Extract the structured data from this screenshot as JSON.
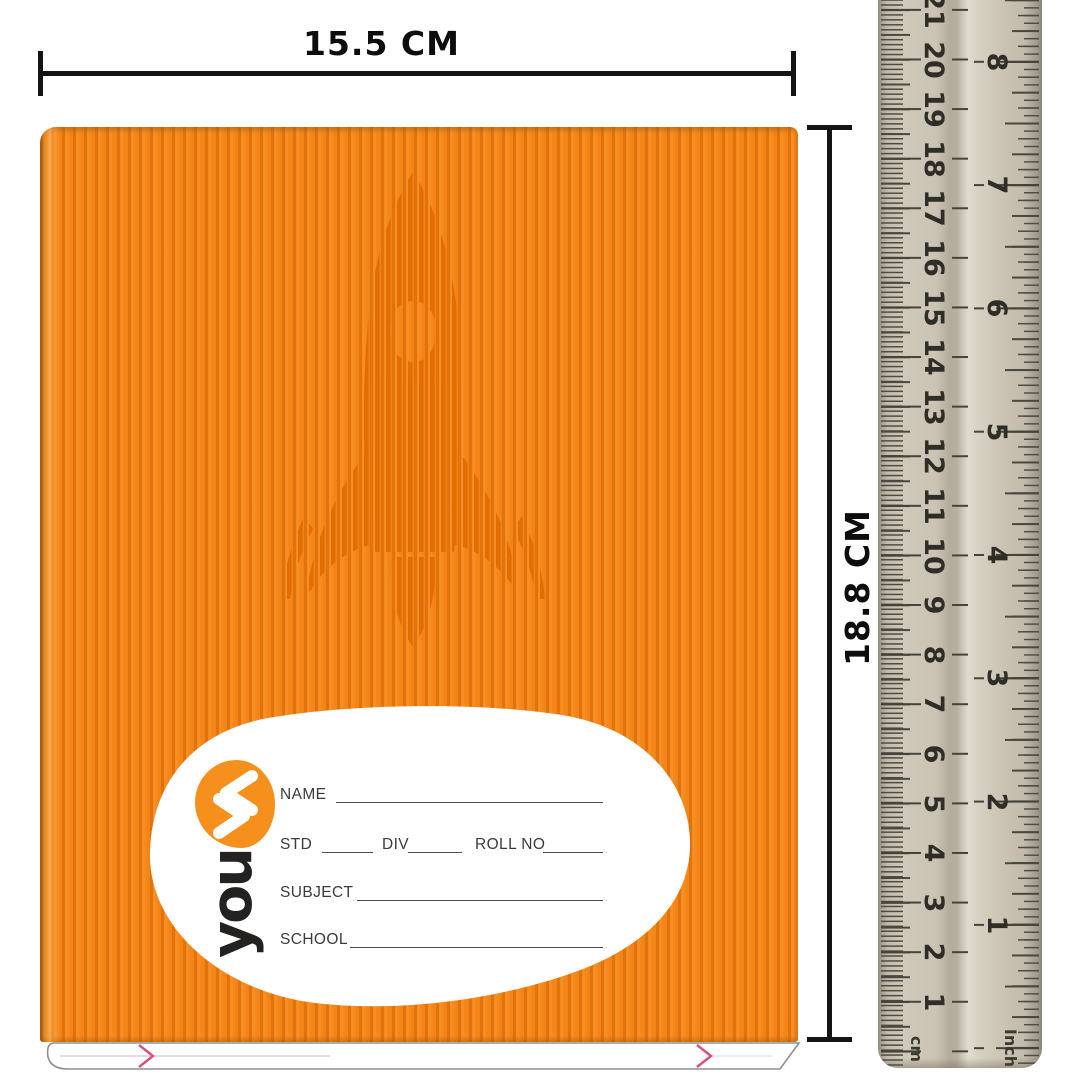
{
  "dimensions": {
    "width_label": "15.5 CM",
    "height_label": "18.8 CM"
  },
  "notebook": {
    "brand": "youva",
    "logo_text": "you",
    "fields": {
      "name_label": "NAME",
      "std_label": "STD",
      "div_label": "DIV",
      "roll_label": "ROLL NO",
      "subject_label": "SUBJECT",
      "school_label": "SCHOOL"
    },
    "colors": {
      "cover_orange": "#f5871a",
      "stripe_dark": "#e2730c",
      "rocket_line": "#e06c00",
      "label_blob": "#ffffff",
      "logo_orange": "#f5901d",
      "logo_text_color": "#232220",
      "field_text": "#3b3a38",
      "page_chevron_pink": "#d94f7d"
    }
  },
  "ruler": {
    "cm_label": "cm",
    "inch_label": "Inch",
    "cm_marks": [
      {
        "label": "21",
        "y": 10
      },
      {
        "label": "20",
        "y": 60
      },
      {
        "label": "19",
        "y": 109
      },
      {
        "label": "18",
        "y": 159
      },
      {
        "label": "17",
        "y": 208
      },
      {
        "label": "16",
        "y": 258
      },
      {
        "label": "15",
        "y": 308
      },
      {
        "label": "14",
        "y": 357
      },
      {
        "label": "13",
        "y": 407
      },
      {
        "label": "12",
        "y": 456
      },
      {
        "label": "11",
        "y": 506
      },
      {
        "label": "10",
        "y": 556
      },
      {
        "label": "9",
        "y": 605
      },
      {
        "label": "8",
        "y": 655
      },
      {
        "label": "7",
        "y": 704
      },
      {
        "label": "6",
        "y": 754
      },
      {
        "label": "5",
        "y": 804
      },
      {
        "label": "4",
        "y": 853
      },
      {
        "label": "3",
        "y": 903
      },
      {
        "label": "2",
        "y": 952
      },
      {
        "label": "1",
        "y": 1002
      }
    ],
    "inch_marks": [
      {
        "label": "8",
        "y": 62
      },
      {
        "label": "7",
        "y": 185
      },
      {
        "label": "6",
        "y": 308
      },
      {
        "label": "5",
        "y": 432
      },
      {
        "label": "4",
        "y": 555
      },
      {
        "label": "3",
        "y": 678
      },
      {
        "label": "2",
        "y": 802
      },
      {
        "label": "1",
        "y": 925
      }
    ],
    "colors": {
      "body_beige": "#c9c2b2",
      "tick_dark": "#45423a",
      "number_color": "#2f2d27"
    }
  }
}
